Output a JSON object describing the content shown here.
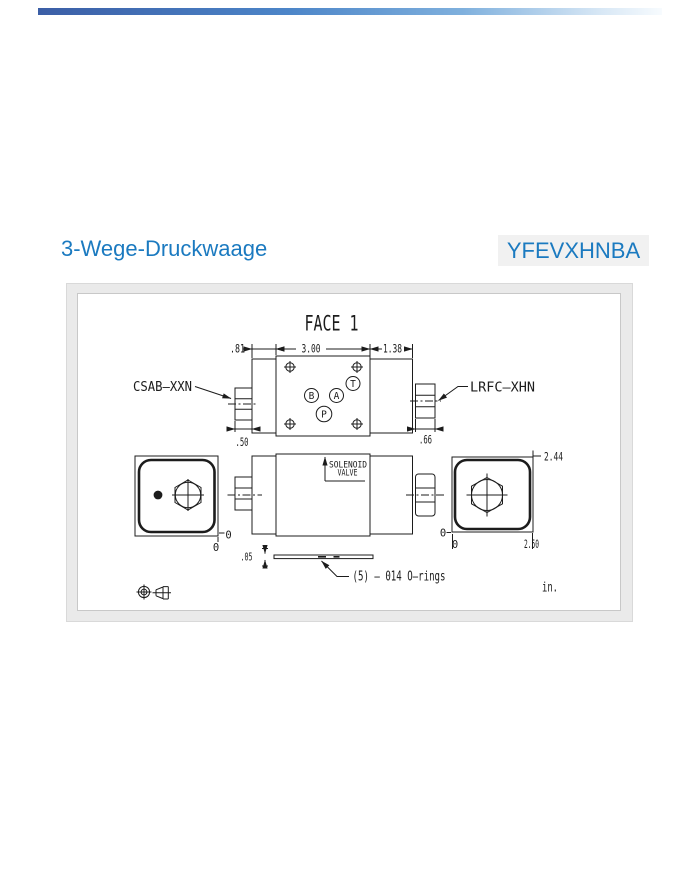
{
  "header": {
    "title": "3-Wege-Druckwaage",
    "part_number": "YFEVXHNBA"
  },
  "colors": {
    "accent_blue": "#1b7ac0",
    "panel_frame": "#eaeaea",
    "badge_background": "#f1f1f1"
  },
  "drawing": {
    "view_title": "FACE 1",
    "left_fitting_label": "CSAB–XXN",
    "right_fitting_label": "LRFC–XHN",
    "solenoid_label_line1": "SOLENOID",
    "solenoid_label_line2": "VALVE",
    "orings_note": "(5) – 014 O–rings",
    "units_label": "in.",
    "ports": {
      "b": "B",
      "a": "A",
      "t": "T",
      "p": "P"
    },
    "dims": {
      "section_left": ".81",
      "section_center": "3.00",
      "section_right": "1.38",
      "nut_left": ".50",
      "nut_right": ".66",
      "height": "2.44",
      "width": "2.50",
      "thickness": ".05",
      "zero_y_left": "0",
      "zero_x_left": "0",
      "zero_y_right": "0",
      "zero_x_right": "0"
    }
  }
}
